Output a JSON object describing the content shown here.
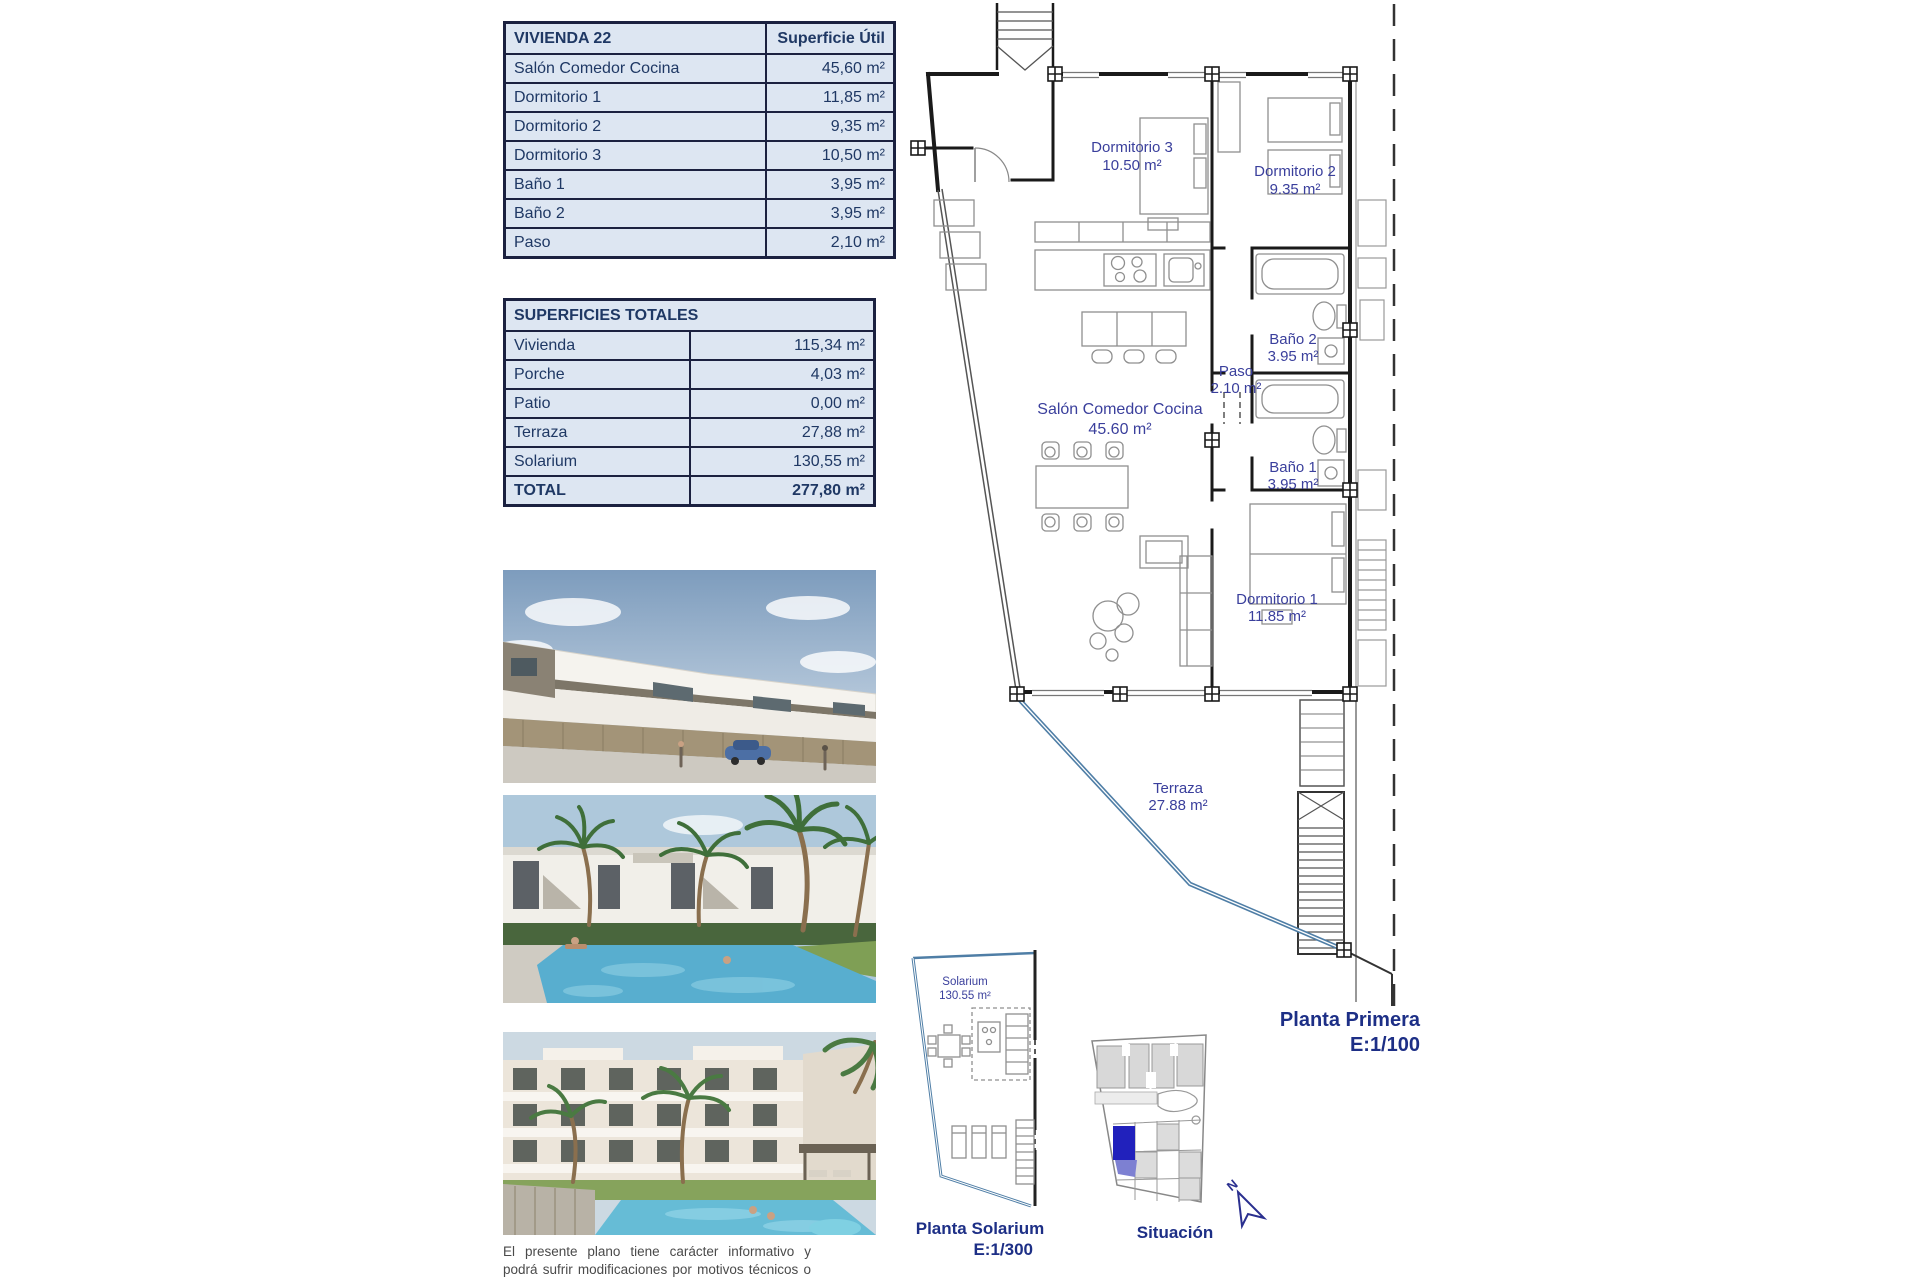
{
  "document": {
    "unit_table": {
      "title": "VIVIENDA 22",
      "header": "Superficie Útil",
      "rows": [
        {
          "label": "Salón Comedor Cocina",
          "value": "45,60 m²"
        },
        {
          "label": "Dormitorio 1",
          "value": "11,85 m²"
        },
        {
          "label": "Dormitorio 2",
          "value": "9,35 m²"
        },
        {
          "label": "Dormitorio 3",
          "value": "10,50 m²"
        },
        {
          "label": "Baño 1",
          "value": "3,95 m²"
        },
        {
          "label": "Baño 2",
          "value": "3,95 m²"
        },
        {
          "label": "Paso",
          "value": "2,10 m²"
        }
      ]
    },
    "totals_table": {
      "title": "SUPERFICIES TOTALES",
      "rows": [
        {
          "label": "Vivienda",
          "value": "115,34 m²"
        },
        {
          "label": "Porche",
          "value": "4,03 m²"
        },
        {
          "label": "Patio",
          "value": "0,00 m²"
        },
        {
          "label": "Terraza",
          "value": "27,88 m²"
        },
        {
          "label": "Solarium",
          "value": "130,55 m²"
        }
      ],
      "total": {
        "label": "TOTAL",
        "value": "277,80 m²"
      }
    },
    "floor_plan": {
      "rooms": {
        "dormitorio3": {
          "name": "Dormitorio 3",
          "area": "10.50 m²"
        },
        "dormitorio2": {
          "name": "Dormitorio 2",
          "area": "9.35 m²"
        },
        "salon": {
          "name": "Salón Comedor Cocina",
          "area": "45.60 m²"
        },
        "paso": {
          "name": "Paso",
          "area": "2.10 m²"
        },
        "bano2": {
          "name": "Baño 2",
          "area": "3.95 m²"
        },
        "bano1": {
          "name": "Baño 1",
          "area": "3.95 m²"
        },
        "dormitorio1": {
          "name": "Dormitorio 1",
          "area": "11.85 m²"
        },
        "terraza": {
          "name": "Terraza",
          "area": "27.88 m²"
        }
      },
      "caption": {
        "title": "Planta Primera",
        "scale": "E:1/100"
      }
    },
    "solarium_plan": {
      "room": {
        "name": "Solarium",
        "area": "130.55 m²"
      },
      "caption": {
        "title": "Planta Solarium",
        "scale": "E:1/300"
      }
    },
    "situation_plan": {
      "caption": "Situación",
      "compass": "N"
    },
    "disclaimer": "El presente plano tiene carácter informativo y podrá sufrir modificaciones por motivos técnicos o jurídicos."
  },
  "colors": {
    "table_fill": "#dde6f2",
    "table_text": "#1f3864",
    "plan_label": "#3a3f9c",
    "caption": "#1d2f86",
    "terrace_line": "#4f7ea6",
    "highlighted_unit": "#2121bc"
  }
}
